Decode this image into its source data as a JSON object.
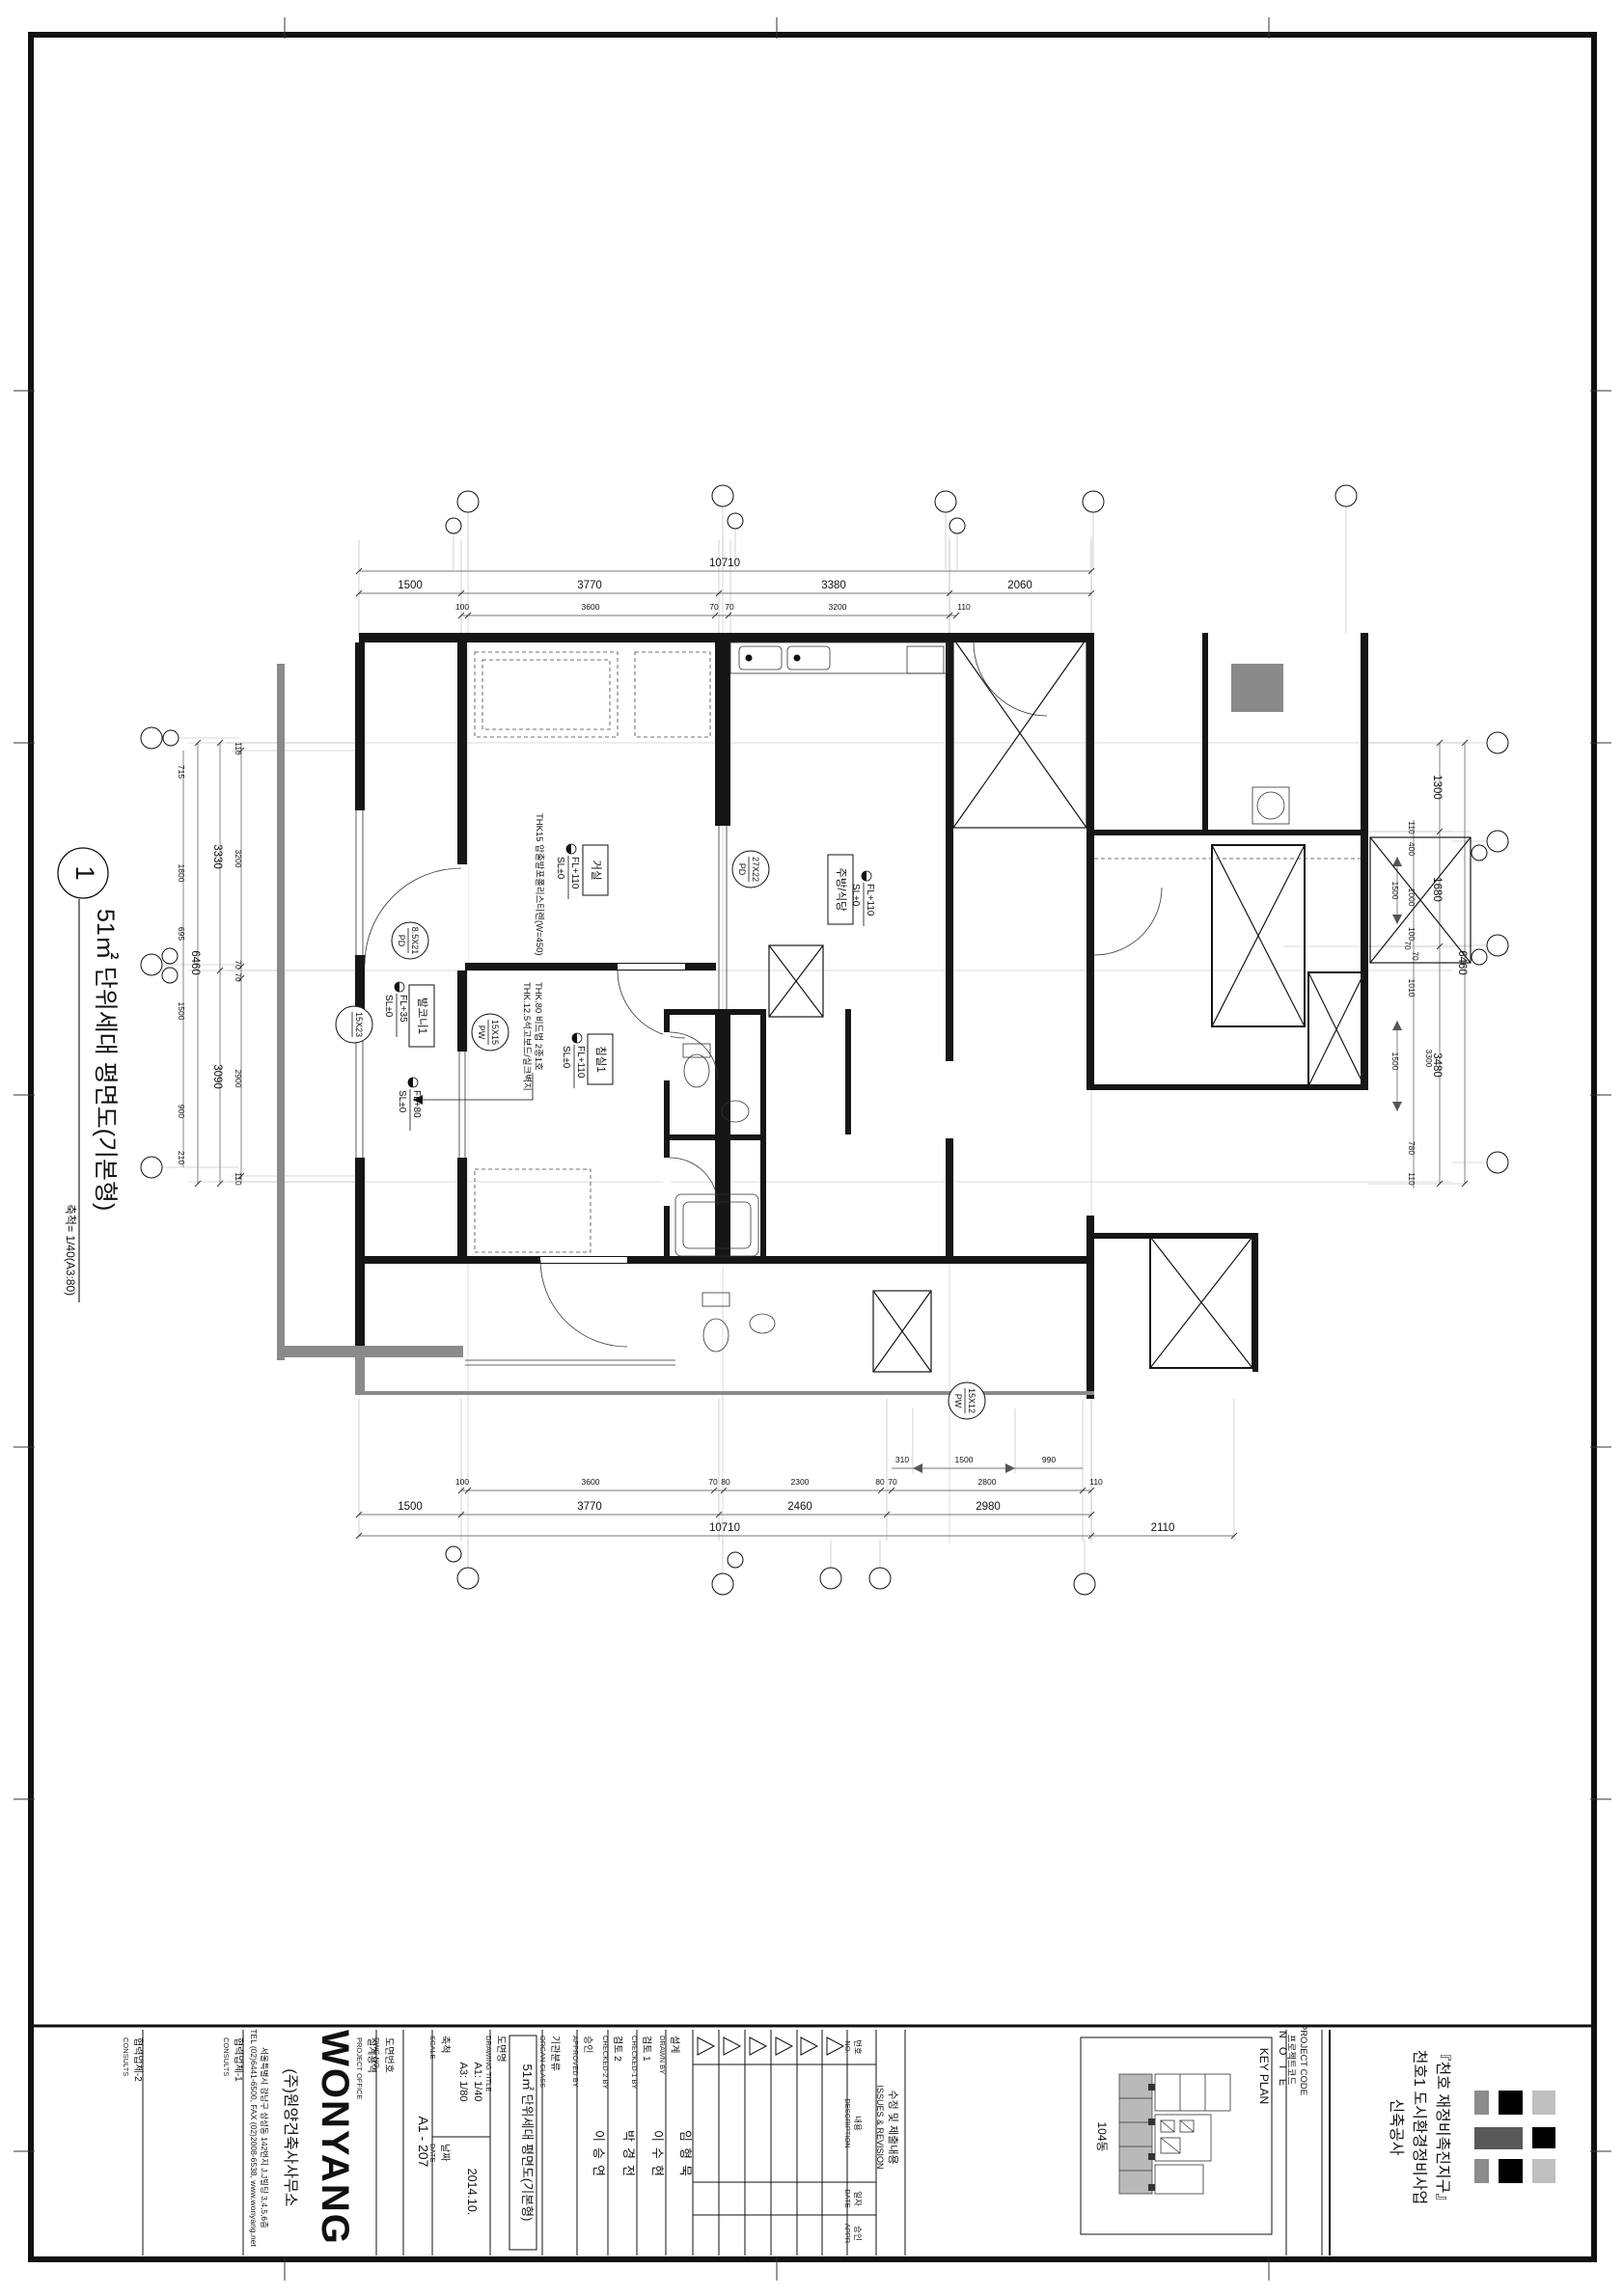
{
  "sheet": {
    "drawing_no_bubble": "1",
    "drawing_title": "51㎡ 단위세대 평면도(기본형)",
    "scale_note": "축척= 1/40(A3:80)"
  },
  "plan": {
    "rooms": [
      {
        "name": "거실",
        "level": "FL+110",
        "slab": "SL±0"
      },
      {
        "name": "주방/식당",
        "level": "FL+110",
        "slab": "SL±0"
      },
      {
        "name": "침실1",
        "level": "FL+110",
        "slab": "SL±0"
      },
      {
        "name": "발코니1",
        "level": "FL+35",
        "slab": "SL±0"
      }
    ],
    "extra_level": {
      "level": "FL+80",
      "slab": "SL±0"
    },
    "tags": [
      {
        "size": "27X22",
        "type": "PD"
      },
      {
        "size": "8.5X21",
        "type": "PD"
      },
      {
        "size": "15X23",
        "type": ""
      },
      {
        "size": "15X15",
        "type": "PW"
      },
      {
        "size": "15X12",
        "type": "PW"
      }
    ],
    "notes": [
      "THK15 압출발포폴리스티렌(W=450)",
      "THK.12.5석고보드/실크벽지",
      "THK.80 비드법 2종1호"
    ]
  },
  "dims": {
    "top_overall": "10710",
    "top2": [
      "1500",
      "3770",
      "3380",
      "2060"
    ],
    "top3": [
      "100",
      "3600",
      "70",
      "70",
      "3200",
      "110"
    ],
    "bot_sub": [
      "310",
      "1500",
      "990"
    ],
    "bot1": [
      "100",
      "3600",
      "70",
      "80",
      "2300",
      "80",
      "70",
      "2800",
      "110"
    ],
    "bot2": [
      "1500",
      "3770",
      "2460",
      "2980"
    ],
    "bot3": [
      "10710",
      "2110"
    ],
    "left_overall": "6460",
    "left2": [
      "3330",
      "3090"
    ],
    "left3": [
      "110",
      "3200",
      "70",
      "70",
      "2900",
      "110"
    ],
    "left_inner": [
      "715",
      "1800",
      "695",
      "1500",
      "900",
      "210"
    ],
    "right_overall": "6460",
    "right2": [
      "1300",
      "1680",
      "3480"
    ],
    "right3": [
      "110",
      "400",
      "1500",
      "1000",
      "100",
      "70",
      "70",
      "1010",
      "1500",
      "3300",
      "780",
      "110"
    ]
  },
  "titleblock": {
    "consults2": {
      "ko": "협력업체-2",
      "en": "CONSULTS"
    },
    "consults1": {
      "ko": "협력업체-1",
      "en": "CONSULTS"
    },
    "office": {
      "ko": "설계용역",
      "en": "PROJECT OFFICE"
    },
    "firm": {
      "logo": "WONYANG",
      "name": "(주)원양건축사사무소",
      "addr": "서울특별시 강남구 삼성동 142번지 J.J빌딩 3,4,5,6층",
      "tel": "TEL (02)6441-6500, FAX (02)2008-6538, www.wonyang.net"
    },
    "dwg_no": {
      "ko": "도면번호",
      "en": "DWG NO.",
      "value": "A1 - 207"
    },
    "scale": {
      "ko": "축척",
      "en": "SCALE",
      "a1": "A1: 1/40",
      "a3": "A3: 1/80"
    },
    "date": {
      "ko": "날짜",
      "en": "DATE",
      "value": "2014.10."
    },
    "dwg_title": {
      "ko": "도면명",
      "en": "DRAWING TITLE",
      "value": "51㎡ 단위세대 평면도(기본형)"
    },
    "organ": {
      "ko": "기관분류",
      "en": "ORGAN CLASS"
    },
    "approved": {
      "ko": "승인",
      "en": "APPROVED BY",
      "value": "이승연"
    },
    "checked2": {
      "ko": "검토 2",
      "en": "CHECKED-2 BY",
      "value": "박경전"
    },
    "checked1": {
      "ko": "검토 1",
      "en": "CHECKED-1 BY",
      "value": "이수현"
    },
    "drawn": {
      "ko": "설계",
      "en": "DRAWN BY",
      "value": "임형묵"
    },
    "rev": {
      "no_ko": "번호",
      "no_en": "NO.",
      "desc_ko": "내용",
      "desc_en": "DESCRIPTION",
      "date_ko": "일자",
      "date_en": "DATE",
      "appr_ko": "승인",
      "appr_en": "APPR",
      "title_ko": "수정 및 제출내용",
      "title_en": "ISSUES & REVISION"
    },
    "note_label": "N O T E",
    "projcode": {
      "ko": "프로젝트코드",
      "en": "PROJECT CODE"
    },
    "keyplan": {
      "label": "KEY PLAN",
      "unit": "104동"
    },
    "project": {
      "line1": "『천호 재정비촉진지구』",
      "line2": "천호1 도시환경정비사업",
      "line3": "신축공사"
    }
  },
  "logo_colors": {
    "gray": "#8c8c8c",
    "black": "#000000",
    "lightgray": "#bfbfbf",
    "darkgray": "#595959"
  }
}
